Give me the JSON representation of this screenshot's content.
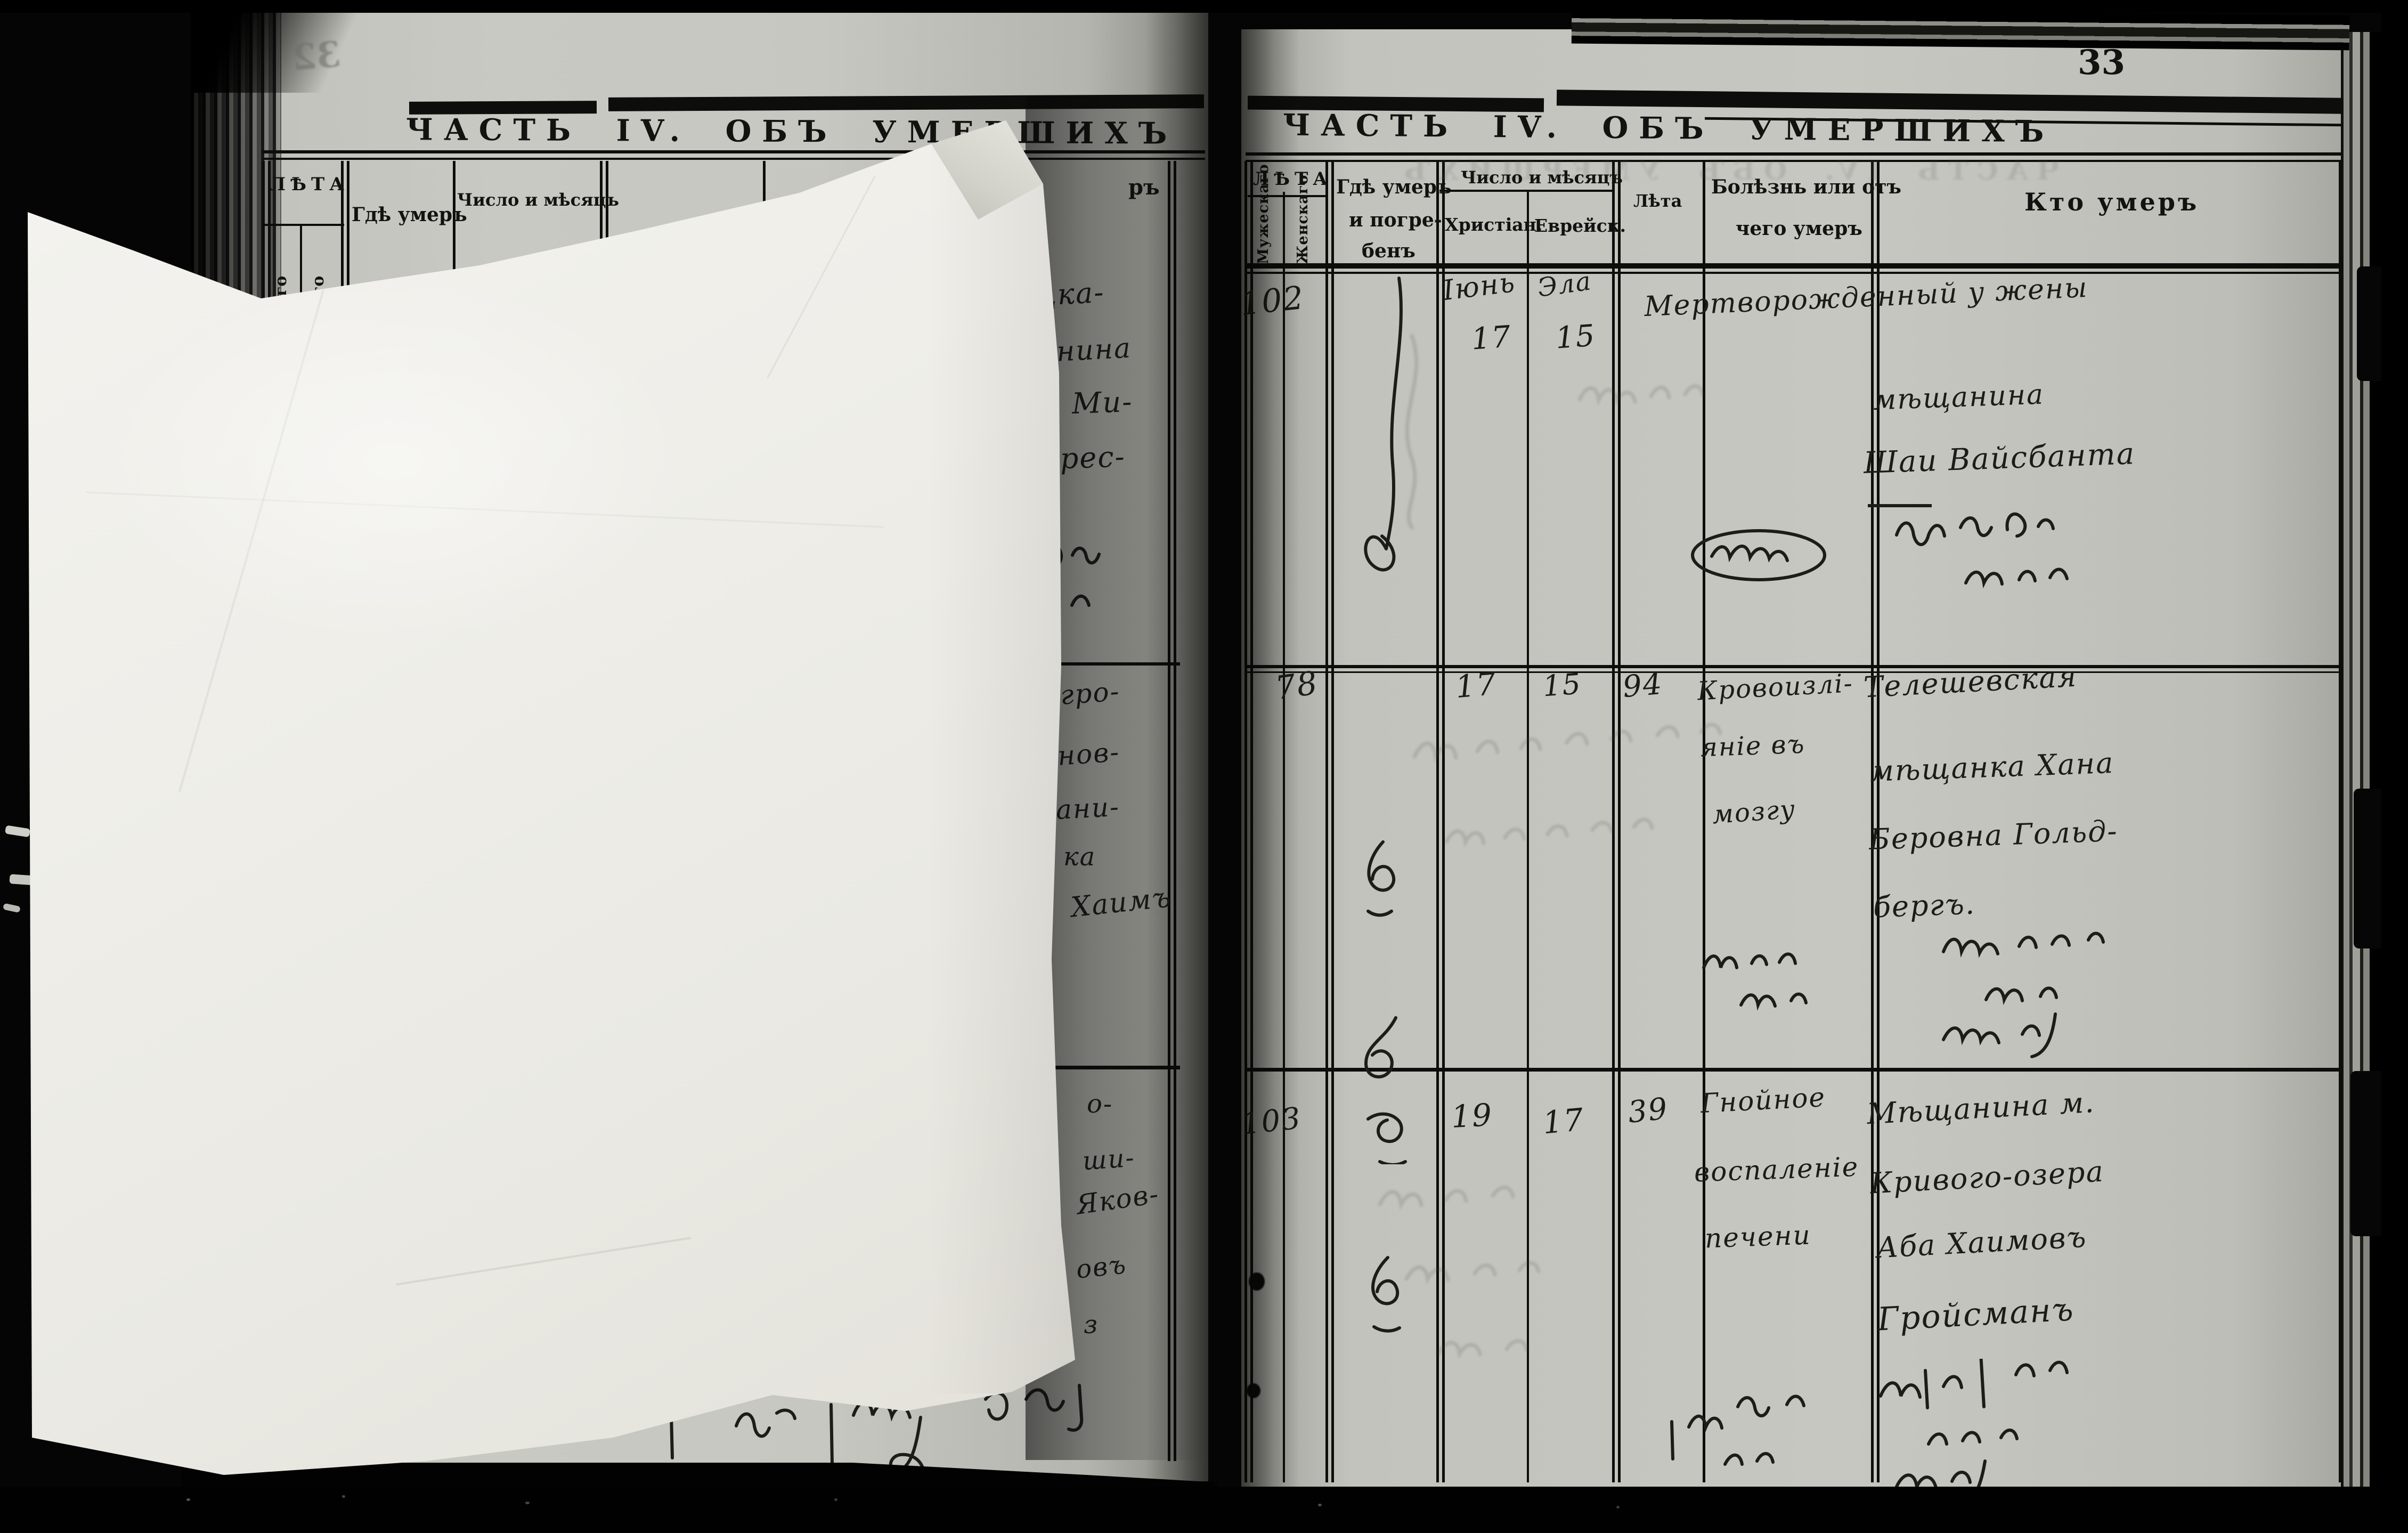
{
  "colors": {
    "book_paper": "#c6c6c0",
    "loose_sheet": "#f0efeb",
    "ink": "#1a1a1a",
    "background": "#000000"
  },
  "left_page": {
    "bleed_number": "32",
    "header": "ЧАСТЬ IV. ОБЪ УМЕРШИХЪ",
    "col_leta": "ЛѢТА",
    "col_where": "Гдѣ умеръ",
    "col_date": "Число и мѣсяцъ",
    "col_who_fragment": "ръ",
    "sub_fragment_1": "го",
    "sub_fragment_2": "го",
    "entry1": [
      "цка-",
      "анина",
      "Ми-",
      "Брес-"
    ],
    "entry2": [
      "гро-",
      "нов-",
      "ани-",
      "ка",
      "Хаимъ"
    ],
    "entry3": [
      "о-",
      "ши-",
      "Яков-",
      "овъ",
      "з"
    ]
  },
  "right_page": {
    "page_number": "33",
    "header": "ЧАСТЬ IV. ОБЪ УМЕРШИХЪ",
    "columns": {
      "leta": "ЛѢТА",
      "male": "Мужескаго",
      "female": "Женскаго",
      "where1": "Гдѣ умеръ",
      "where2": "и погре-",
      "where3": "бенъ",
      "date": "Число и мѣсяцъ",
      "christian": "Христіан.",
      "jewish": "Еврейск.",
      "age": "Лѣта",
      "cause1": "Болѣзнь или отъ",
      "cause2": "чего умеръ",
      "who": "Кто умеръ"
    },
    "rows": [
      {
        "no": "102",
        "month_c": "Іюнь",
        "day_c": "17",
        "month_j": "Эла",
        "day_j": "15",
        "age": "",
        "line1": "Мертворожденный у жены",
        "line2": "мѣщанина",
        "line3": "Шаи Вайсбанта"
      },
      {
        "no": "78",
        "day_c": "17",
        "day_j": "15",
        "age": "94",
        "cause": [
          "Кровоизлі-",
          "яніе въ",
          "мозгу"
        ],
        "who": [
          "Телешевская",
          "мѣщанка Хана",
          "Беровна Гольд-",
          "бергъ."
        ]
      },
      {
        "no": "103",
        "day_c": "19",
        "day_j": "17",
        "age": "39",
        "cause": [
          "Гнойное",
          "воспаленіе",
          "печени"
        ],
        "who": [
          "Мѣщанина м.",
          "Кривого-озера",
          "Аба Хаимовъ",
          "Гройсманъ"
        ]
      }
    ]
  }
}
